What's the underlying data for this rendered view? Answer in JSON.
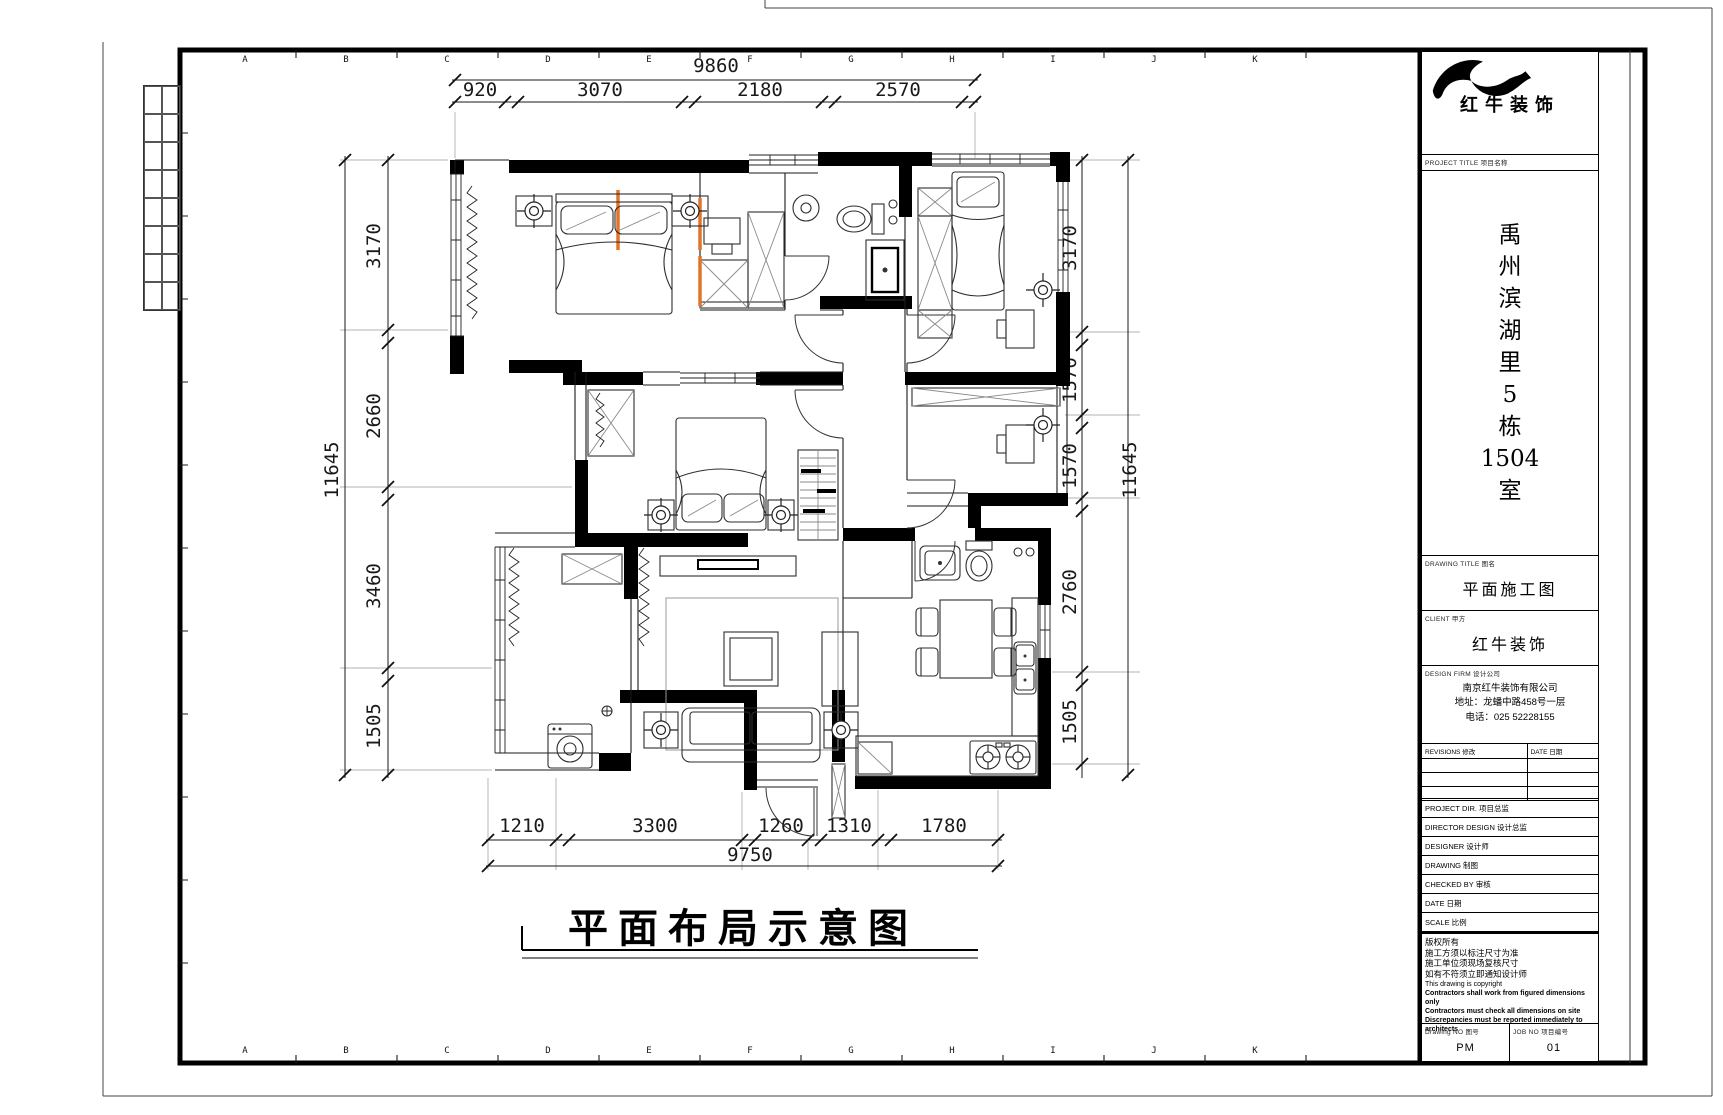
{
  "sheet": {
    "grid_letters": [
      "A",
      "B",
      "C",
      "D",
      "E",
      "F",
      "G",
      "H",
      "I",
      "J",
      "K"
    ]
  },
  "plan": {
    "title": "平面布局示意图",
    "dims": {
      "top": {
        "overall": "9860",
        "segments": [
          "920",
          "3070",
          "2180",
          "2570"
        ]
      },
      "left": {
        "overall": "11645",
        "segments": [
          "3170",
          "2660",
          "3460",
          "1505"
        ]
      },
      "right": {
        "overall": "11645",
        "segments": [
          "3170",
          "1570",
          "1570",
          "2760",
          "1505"
        ]
      },
      "bottom": {
        "overall": "9750",
        "segments": [
          "1210",
          "3300",
          "1260",
          "1310",
          "1780"
        ]
      }
    }
  },
  "titleblock": {
    "brand": "红牛装饰",
    "project_label": "PROJECT TITLE 项目名称",
    "project_name_lines": [
      "禹",
      "州",
      "滨",
      "湖",
      "里",
      "5",
      "栋",
      "1504",
      "室"
    ],
    "drawing_title_label": "DRAWING TITLE 图名",
    "drawing_title": "平面施工图",
    "client_label": "CLIENT 甲方",
    "client": "红牛装饰",
    "firm_label": "DESIGN FIRM 设计公司",
    "firm_lines": [
      "南京红牛装饰有限公司",
      "地址：龙蟠中路458号一层",
      "电话：025 52228155"
    ],
    "revisions_label": "REVISIONS 修改",
    "revisions_date_label": "DATE 日期",
    "fields": [
      {
        "label": "PROJECT DIR. 项目总监"
      },
      {
        "label": "DIRECTOR DESIGN 设计总监"
      },
      {
        "label": "DESIGNER 设计师"
      },
      {
        "label": "DRAWING 制图"
      },
      {
        "label": "CHECKED BY 审核"
      },
      {
        "label": "DATE 日期"
      },
      {
        "label": "SCALE 比例"
      }
    ],
    "notes": [
      "版权所有",
      "施工方须以标注尺寸为准",
      "施工单位须现场复核尺寸",
      "如有不符须立即通知设计师",
      "This drawing is copyright",
      "Contractors shall work from figured dimensions only",
      "Contractors must check all dimensions on site",
      "Discrepancies must be reported immediately to architects"
    ],
    "drawing_no_label": "Drawing NO 图号",
    "drawing_no": "PM",
    "job_no_label": "JOB NO 项目编号",
    "job_no": "01"
  }
}
